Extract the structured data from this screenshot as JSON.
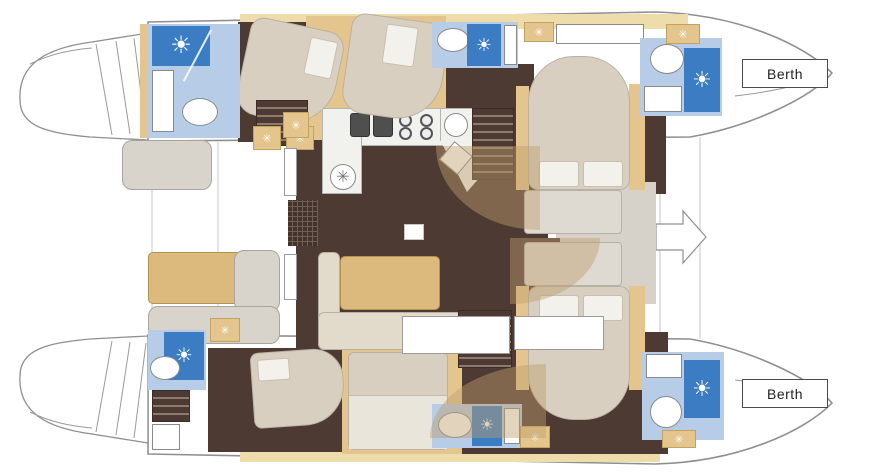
{
  "diagram": {
    "type": "catamaran-floorplan",
    "berth_labels": {
      "port": "Berth",
      "starboard": "Berth"
    }
  },
  "icons": {
    "shower_sun": "☀",
    "deck_hatch": "✳",
    "galley_fan": "✳"
  },
  "colors": {
    "outline": "#8f8f8f",
    "tan": "#e3c58d",
    "tan_light": "#eedcab",
    "tan_table": "#dcba7e",
    "dark": "#4d3a33",
    "bath": "#b7cde7",
    "shower": "#3b7cc3",
    "counter": "#f1f1ed",
    "seat": "#d8d3cb",
    "sofa": "#e2dacb",
    "bed": "#d8cfc0",
    "pillow": "#f3f1ec",
    "walkway": "#d6d1c9",
    "stair_slat": "#8d7b6d",
    "door_fan": "rgba(190,158,108,0.45)",
    "berth_border": "#4a4a4a",
    "window_border": "#9a9a9a",
    "text": "#222222"
  }
}
